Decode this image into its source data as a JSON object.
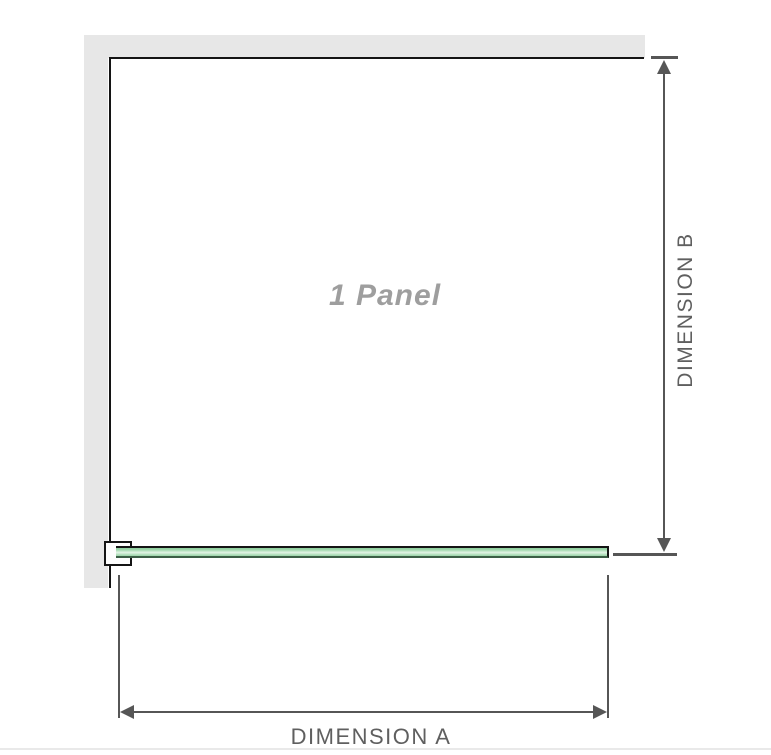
{
  "diagram": {
    "panel_label": "1 Panel",
    "dimensions": {
      "a_label": "DIMENSION A",
      "b_label": "DIMENSION B"
    }
  },
  "icons": {
    "dimension_b": [
      "arrow-up-icon",
      "arrow-down-icon"
    ],
    "dimension_a": [
      "arrow-left-icon",
      "arrow-right-icon"
    ]
  },
  "colors": {
    "wall": "#e7e7e7",
    "panel_outline": "#141414",
    "glass_fill": "#a8dcb4",
    "glass_highlight": "#e2f4e5",
    "glass_shade": "#8fcd9e",
    "glass_bottom_edge": "#3c5f46",
    "dimension_line": "#565656",
    "dimension_text": "#5f5f5f",
    "panel_label_text": "#9e9e9e",
    "page_edge": "#e9e9e9"
  }
}
